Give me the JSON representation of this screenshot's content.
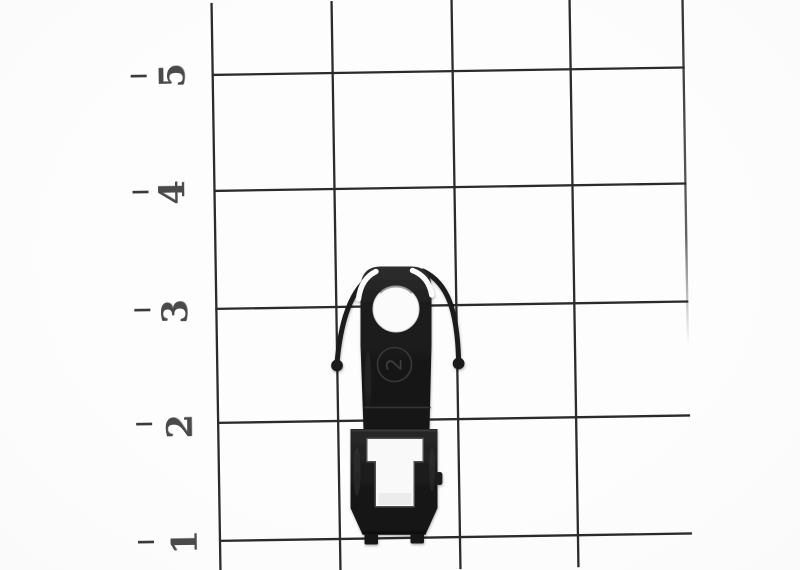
{
  "scene": {
    "description": "Black plastic model coupler clip photographed on centimeter graph paper"
  },
  "ruler": {
    "labels": [
      "5",
      "4",
      "3",
      "2",
      "1"
    ]
  },
  "part": {
    "marking": "2"
  },
  "colors": {
    "paper": "#fcfcfc",
    "grid_line": "#2b2b2b",
    "ruler_label": "#4a4a4a",
    "part_body": "#1b1b1b",
    "part_highlight": "#3e3e3e",
    "opening_white": "#f9f9f9"
  }
}
